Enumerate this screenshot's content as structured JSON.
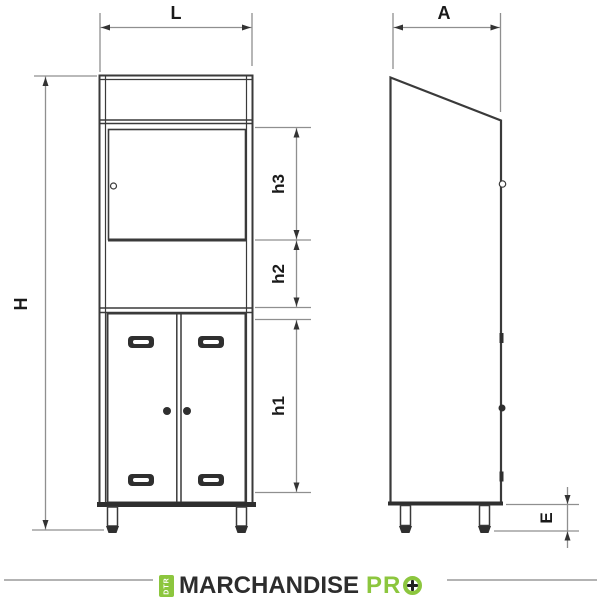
{
  "dimensions": {
    "width": "L",
    "depth": "A",
    "height": "H",
    "section_top": "h3",
    "section_middle": "h2",
    "section_bottom": "h1",
    "leg_height": "E"
  },
  "logo": {
    "badge_text": "DTR",
    "brand": "MARCHANDISE",
    "brand_suffix": "PR",
    "suffix_o_icon": "plus-circle-icon",
    "green": "#8CC63E",
    "text_color": "#2D2D2D"
  },
  "colors": {
    "background": "#FFFFFF",
    "cabinet_outline": "#3A3A3A",
    "dimension_line": "#8F8F8F",
    "arrowhead": "#333333",
    "label_text": "#1A1A1A",
    "logo_rule": "#B3B3B3"
  }
}
